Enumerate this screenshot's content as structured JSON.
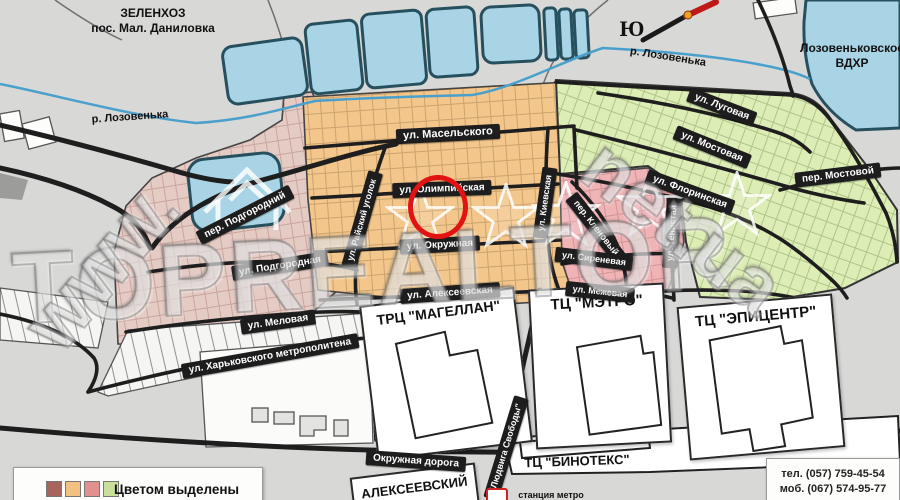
{
  "labels": {
    "settlement_line1": "ЗЕЛЕНХОЗ",
    "settlement_line2": "пос. Мал. Даниловка",
    "river": "р. Лозовенька",
    "reservoir_line1": "Лозовеньковское",
    "reservoir_line2": "ВДХР",
    "compass_south": "Ю",
    "district": "АЛЕКСЕЕВСКИЙ",
    "metro_station": "станция метро"
  },
  "streets": [
    {
      "name": "ул. Масельского"
    },
    {
      "name": "ул. Олимпийская"
    },
    {
      "name": "ул. Окружная"
    },
    {
      "name": "ул. Алексеевская"
    },
    {
      "name": "ул. Киевская"
    },
    {
      "name": "ул. Райский уголок"
    },
    {
      "name": "пер. Подгородний"
    },
    {
      "name": "ул. Подгородная"
    },
    {
      "name": "ул. Меловая"
    },
    {
      "name": "ул. Харьковского метрополитена"
    },
    {
      "name": "пер. Кленовый"
    },
    {
      "name": "ул. Сиреневая"
    },
    {
      "name": "ул. Межевая"
    },
    {
      "name": "ул. Луговая"
    },
    {
      "name": "ул. Мостовая"
    },
    {
      "name": "пер. Мостовой"
    },
    {
      "name": "ул. Флоринская"
    },
    {
      "name": "ул. Тенистая"
    },
    {
      "name": "Окружная дорога"
    },
    {
      "name": "\"Людвига Свободы\""
    }
  ],
  "malls": [
    {
      "name": "ТРЦ \"МАГЕЛЛАН\""
    },
    {
      "name": "ТЦ \"МЭТРО\""
    },
    {
      "name": "ТЦ \"ЭПИЦЕНТР\""
    },
    {
      "name": "ТЦ \"БИНОТЕКС\""
    }
  ],
  "legend": {
    "title": "Цветом выделены",
    "colors": [
      "#a7635c",
      "#f2c181",
      "#e2908d",
      "#c9df9b"
    ]
  },
  "contacts": {
    "phone": "тел. (057) 759-45-54",
    "mobile": "моб. (067) 574-95-77"
  },
  "watermark": {
    "brand": "TOPREALTOR",
    "www": "WWW.",
    "domain": "net.ua"
  },
  "map_colors": {
    "orange_district": "#f3c78c",
    "rose_district": "#e4cbc4",
    "pink_district": "#f0b3b6",
    "green_district": "#dcedb6",
    "water": "#a9d4e6",
    "background": "#d8d8d6"
  }
}
